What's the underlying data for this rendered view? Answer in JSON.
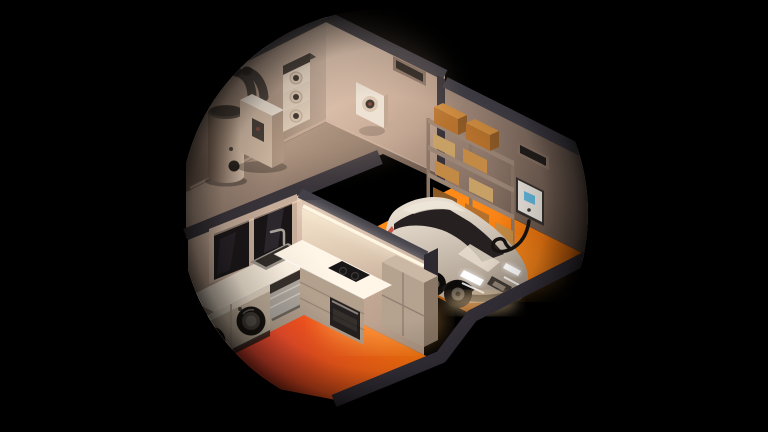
{
  "scene": {
    "title": "Isometric cutaway illustration of a smart home: utility room with heat pump and hot-water tank, kitchen with appliances, and garage with charging electric car",
    "type": "3d-isometric-cutaway-illustration",
    "mask_shape": "circle",
    "canvas": {
      "width": 768,
      "height": 432
    },
    "rooms": [
      {
        "name": "utility-room",
        "objects": [
          "hot-water-tank",
          "heat-pump-unit",
          "air-duct-elbows",
          "ventilation-stack-unit",
          "wall-hrv-box",
          "recessed-wall-vent"
        ]
      },
      {
        "name": "garage",
        "objects": [
          "electric-car",
          "ev-wallbox-charger",
          "charging-cable",
          "storage-shelving",
          "cardboard-boxes",
          "recessed-wall-vent",
          "heated-orange-floor"
        ]
      },
      {
        "name": "kitchen",
        "objects": [
          "window",
          "sink",
          "faucet",
          "dishwasher-open",
          "washing-machine",
          "dryer",
          "induction-hob",
          "oven",
          "tall-cabinet",
          "led-strip-light",
          "glowing-red-orange-floor"
        ]
      }
    ]
  },
  "colors": {
    "bg": "#000000",
    "cap_dark": "#434049",
    "cap_mid": "#3a353b",
    "rim_dark": "#36313a",
    "connector": "#36323a",
    "ul_light": "#d9c1b0",
    "ul_dark": "#715c4f",
    "ur_light": "#e0c6b4",
    "ur_dark": "#a78b7a",
    "ufloor_light": "#a78f7e",
    "ufloor_dark": "#6b584c",
    "gwall_light": "#a2897a",
    "gwall_dark": "#5b4a40",
    "gfloor_light": "#ff8a18",
    "gfloor_dark": "#d65d05",
    "kwall_light": "#e0c5b2",
    "kwall_dark": "#a28875",
    "kwall2_light": "#d8bda9",
    "kwall2_dark": "#b59b88",
    "kfloor_red": "#ff4030",
    "kfloor_orange": "#ff7f06",
    "counter_light": "#fff6e8",
    "counter_dark": "#e6d9c8",
    "counter_front": "#b3a08d",
    "cabinet_front": "#b5a28f",
    "cabinet_side": "#8a7765",
    "cabinet_top": "#cbb8a4",
    "car_light": "#e7ddcf",
    "car_dark": "#a39586",
    "car_glass": "#262120",
    "wheel_dark": "#0d0b0a",
    "wheel_rim": "#5a544d",
    "headlight": "#ffffff",
    "charger_body": "#e9e3dc",
    "charger_screen": "#62b7db",
    "cable": "#161310",
    "box_orange": "#b5712c",
    "box_tan": "#c7a066",
    "box_light": "#c28a44",
    "box_brown": "#8d5a26",
    "shelf_frame": "#9a8474",
    "shelf_post": "#8b7666",
    "tank_light": "#d6bfab",
    "tank_dark": "#6e594b",
    "tank_cap": "#2c2724",
    "hp_front": "#c9b4a1",
    "hp_top": "#ece4d9",
    "hp_side": "#a58e7c",
    "duct": "#37312e",
    "stack_face": "#e9dbcb",
    "stack_cap": "#332f2b",
    "vent_hole": "#2c2725",
    "wallbox_body": "#ece4da",
    "vent_inner": "#221e1c",
    "vent_frame": "#8c7566",
    "glass_dark": "#1b1719",
    "frame_wood": "#c6ad9a",
    "unit_front": "#bcab97",
    "door_outer": "#17130f",
    "door_ring": "#3e3833",
    "door_glass": "#565049",
    "dw_door": "#aaa49c",
    "steel": "#9a938a",
    "basin": "#312c28",
    "oven": "#242020",
    "hob": "#191617",
    "led": "#fff6e2",
    "glow_warm": "#ffb254",
    "glow_red": "#ff5a43",
    "glow_orange": "#ffa435"
  }
}
